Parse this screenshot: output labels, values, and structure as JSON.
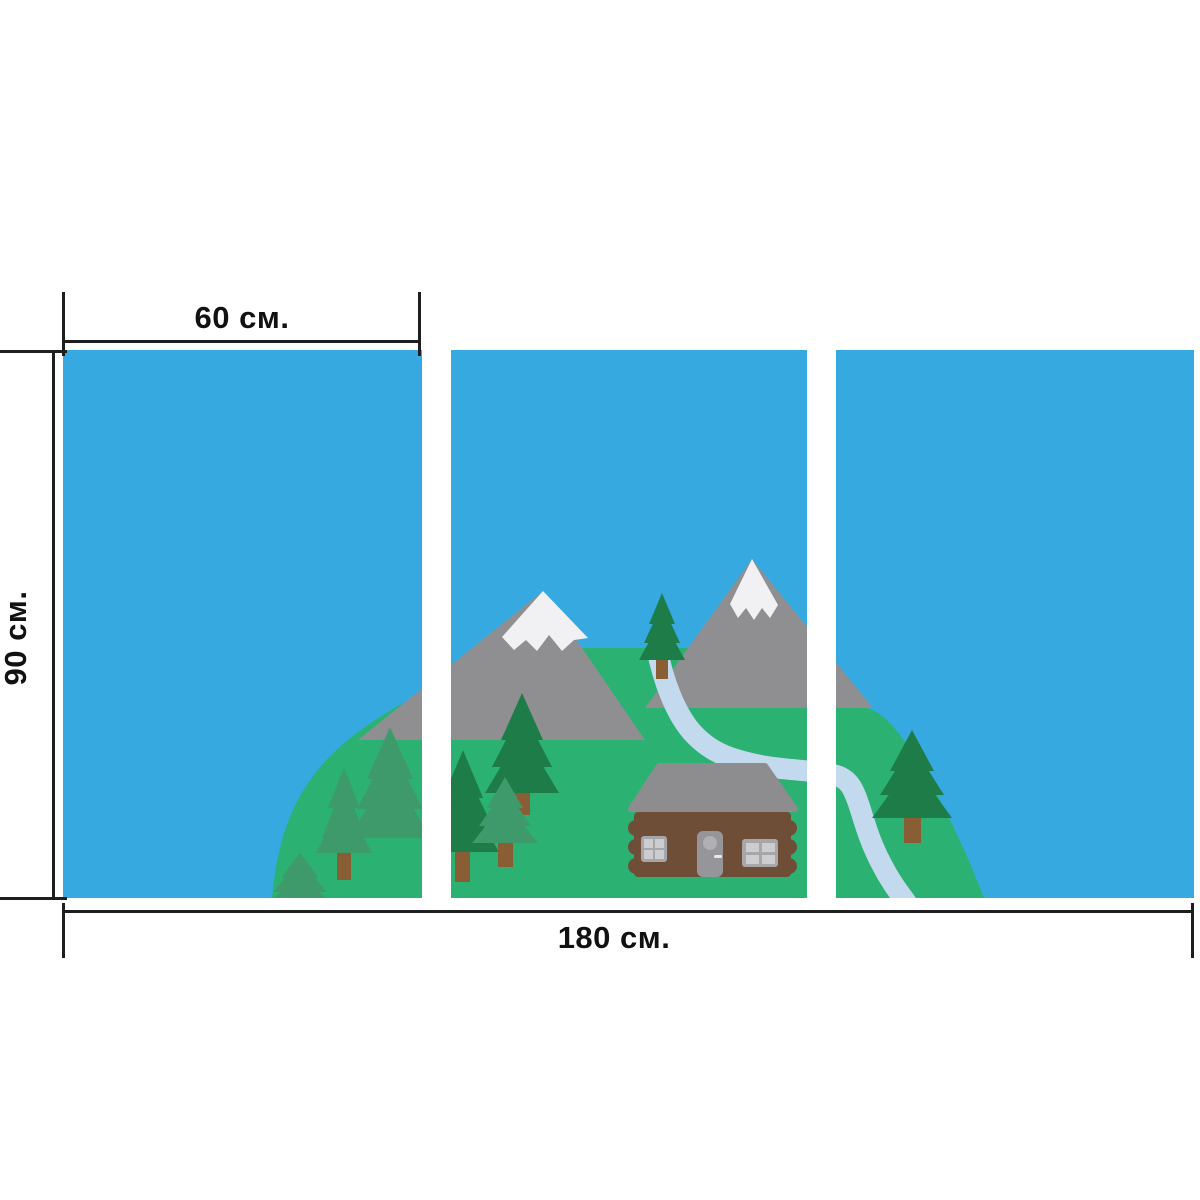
{
  "labels": {
    "panel_width": "60 см.",
    "panel_height": "90 см.",
    "total_width": "180 см."
  },
  "panels": {
    "count": 3,
    "names": [
      "left-panel",
      "center-panel",
      "right-panel"
    ]
  },
  "scene_elements": [
    "sky",
    "green-hill",
    "snowy-mountains",
    "pine-trees",
    "log-cabin",
    "river"
  ],
  "colors": {
    "bg": "#ffffff",
    "line": "#1e1e1e",
    "text": "#111111",
    "sky": "#36a9e1",
    "hill": "#2bb273",
    "mountain": "#8f8f91",
    "snow": "#f1f1f3",
    "tree-dark": "#1e7c48",
    "tree-light": "#3e9a6b",
    "trunk": "#8a5e35",
    "cabin": "#6f4e38",
    "roof": "#8d8d8f",
    "door": "#96969a",
    "door-window": "#b0b0b2",
    "knob": "#e8e8e8",
    "window-frame": "#a7a7a9",
    "window-pane": "#cdcdcf",
    "river": "#c3daee"
  }
}
